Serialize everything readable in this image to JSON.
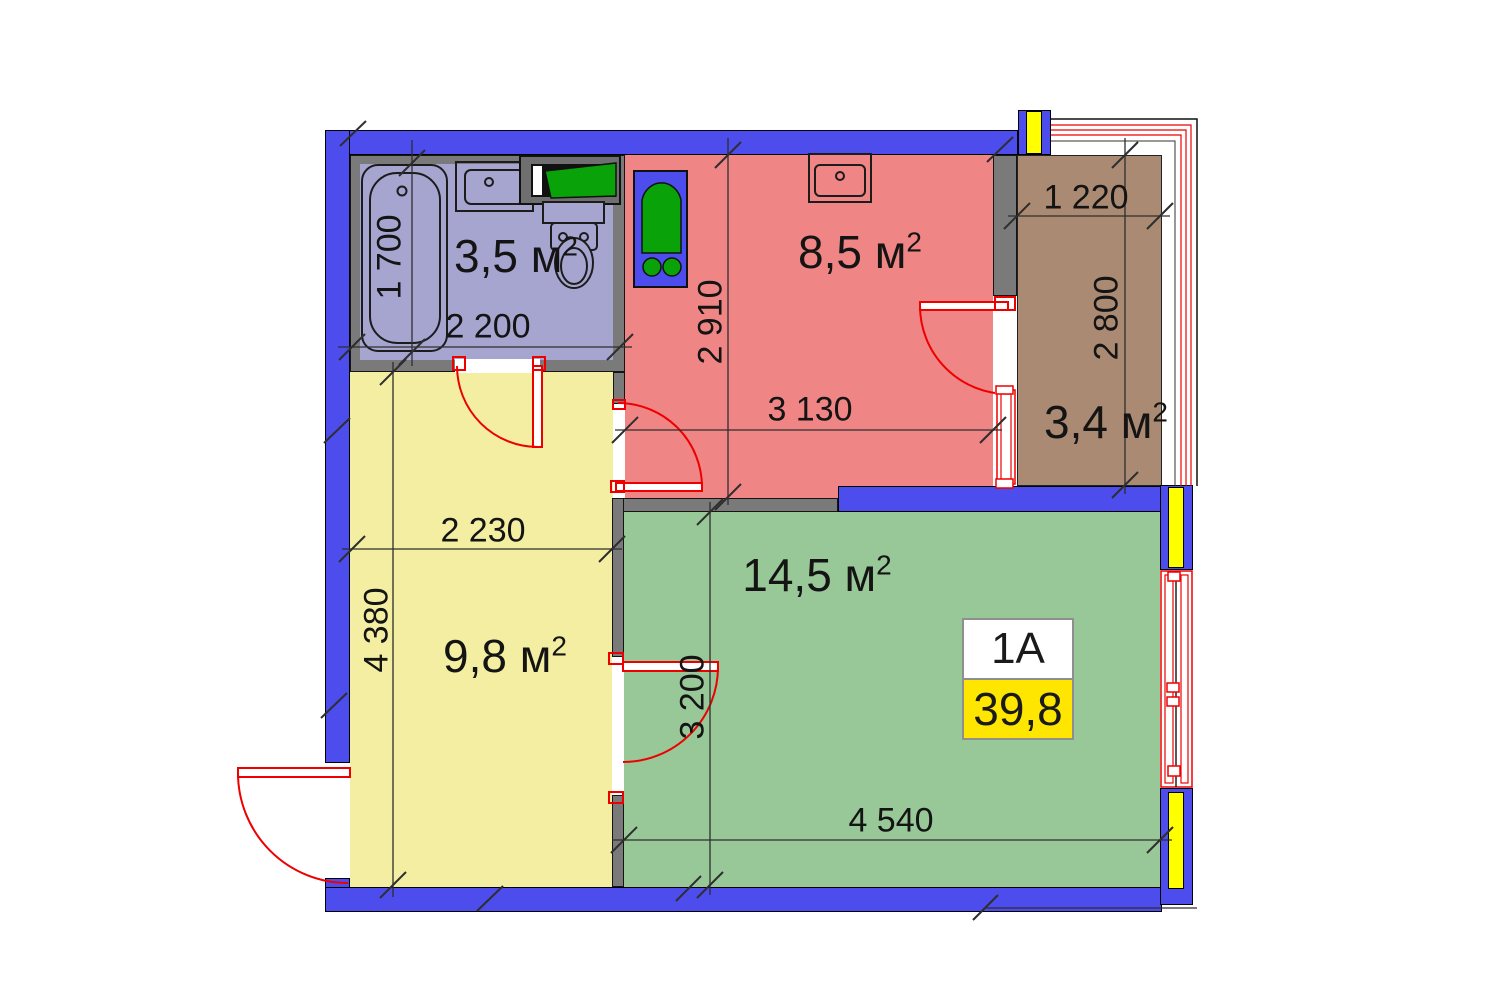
{
  "plan": {
    "unit_badge": {
      "unit_name": "1A",
      "total_area": "39,8"
    }
  },
  "rooms": [
    {
      "name": "bathroom",
      "area_label": "3,5 м",
      "area_sup": "2"
    },
    {
      "name": "kitchen",
      "area_label": "8,5 м",
      "area_sup": "2"
    },
    {
      "name": "balcony",
      "area_label": "3,4 м",
      "area_sup": "2"
    },
    {
      "name": "hallway",
      "area_label": "9,8 м",
      "area_sup": "2"
    },
    {
      "name": "living-room",
      "area_label": "14,5 м",
      "area_sup": "2"
    }
  ],
  "dimensions": {
    "bathtub_length": "1 700",
    "bathroom_width": "2 200",
    "kitchen_depth": "2 910",
    "kitchen_width": "3 130",
    "balcony_width": "1 220",
    "balcony_depth": "2 800",
    "hallway_width": "2 230",
    "hallway_depth": "4 380",
    "living_room_depth": "3 200",
    "living_room_width": "4 540"
  },
  "colors": {
    "load_bearing_wall": "#4d4dee",
    "interior_wall": "#7a7a7a",
    "column_accent": "#ffff00",
    "bathroom_floor": "#a5a5d0",
    "kitchen_floor": "#f08585",
    "hallway_floor": "#f3eea2",
    "living_room_floor": "#98c798",
    "balcony_floor": "#aa8a72",
    "door_swing": "#ee0000",
    "fixture_green": "#09a309",
    "badge_area_bg": "#ffe600"
  }
}
